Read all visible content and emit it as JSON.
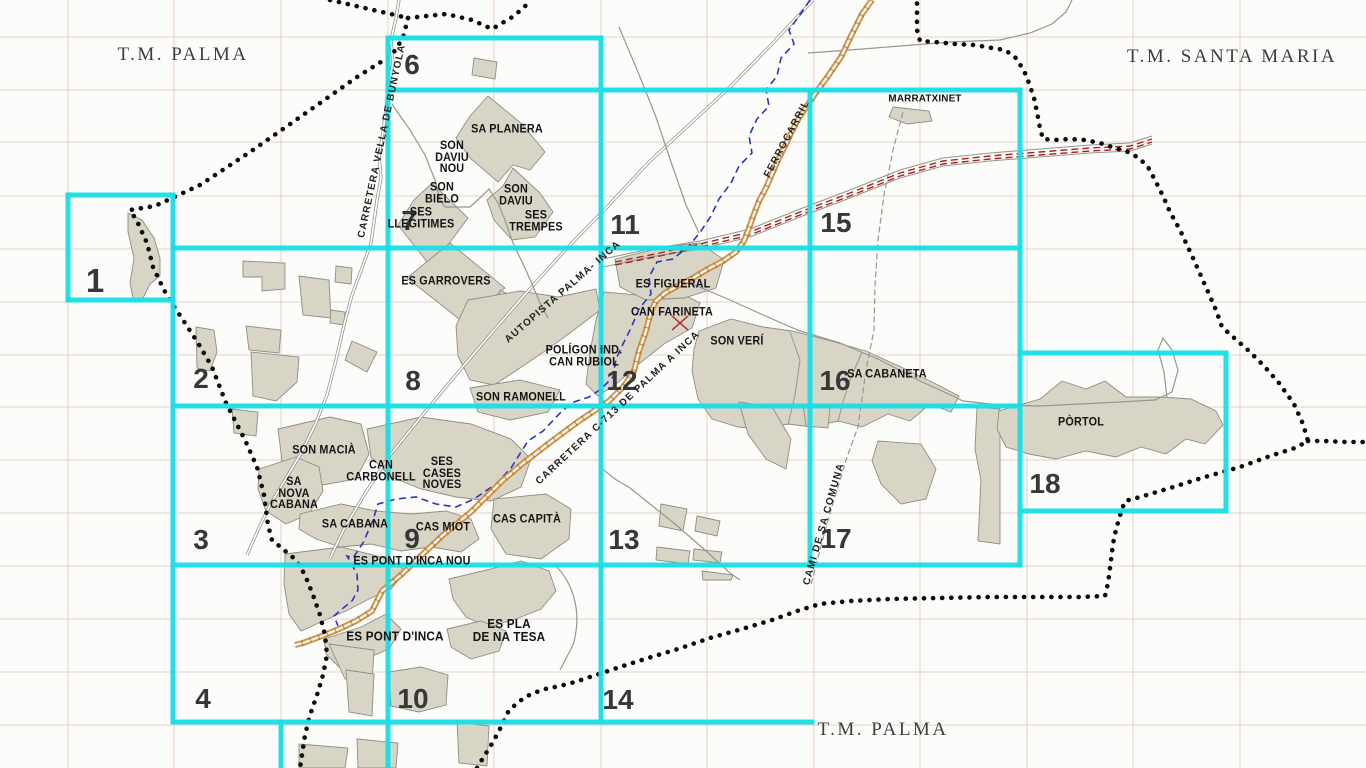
{
  "colors": {
    "background": "#fcfcfa",
    "sheet_grid": "#19dfe6",
    "boundary": "#0d0d0d",
    "railway": "#cd9043",
    "rail_core": "#f8f4ea",
    "rail_ties": "#9b6a28",
    "stream": "#2d35bd",
    "survey_grid": "#c98a80",
    "building_fill": "#d8d4c6",
    "building_outline": "#8f8e85",
    "road": "#979792",
    "red_line": "#a62421",
    "label": "#141414",
    "number": "#373737",
    "tm_label": "#3d3d3d"
  },
  "corner_labels": {
    "top_left": "T.M. PALMA",
    "top_right": "T.M. SANTA MARIA",
    "bottom": "T.M. PALMA"
  },
  "sheets": [
    {
      "number": "1"
    },
    {
      "number": "2"
    },
    {
      "number": "3"
    },
    {
      "number": "4"
    },
    {
      "number": "6"
    },
    {
      "number": "7"
    },
    {
      "number": "8"
    },
    {
      "number": "9"
    },
    {
      "number": "10"
    },
    {
      "number": "11"
    },
    {
      "number": "12"
    },
    {
      "number": "13"
    },
    {
      "number": "14"
    },
    {
      "number": "15"
    },
    {
      "number": "16"
    },
    {
      "number": "17"
    },
    {
      "number": "18"
    }
  ],
  "places": [
    {
      "text": "SA PLANERA"
    },
    {
      "text": "SON\nDAVIU\nNOU"
    },
    {
      "text": "SON\nDAVIU"
    },
    {
      "text": "SON\nBIELO"
    },
    {
      "text": "SES\nLLEGITIMES"
    },
    {
      "text": "SES\nTREMPES"
    },
    {
      "text": "ES GARROVERS"
    },
    {
      "text": "MARRATXINET"
    },
    {
      "text": "ES FIGUERAL"
    },
    {
      "text": "CAN FARINETA"
    },
    {
      "text": "SON VERÍ"
    },
    {
      "text": "POLÍGON IND.\nCAN RUBIOL"
    },
    {
      "text": "SON RAMONELL"
    },
    {
      "text": "SA CABANETA"
    },
    {
      "text": "PÒRTOL"
    },
    {
      "text": "SON MACIÀ"
    },
    {
      "text": "CAN\nCARBONELL"
    },
    {
      "text": "SES\nCASES\nNOVES"
    },
    {
      "text": "SA\nNOVA\nCABANA"
    },
    {
      "text": "SA CABANA"
    },
    {
      "text": "CAS MIOT"
    },
    {
      "text": "CAS CAPITÀ"
    },
    {
      "text": "ES PONT D'INCA NOU"
    },
    {
      "text": "ES PONT D'INCA"
    },
    {
      "text": "ES PLA\nDE NA TESA"
    }
  ],
  "roads": [
    {
      "text": "CARRETERA VELLA DE BUNYOLA"
    },
    {
      "text": "AUTOPISTA PALMA- INCA"
    },
    {
      "text": "FERROCARRIL"
    },
    {
      "text": "CARRETERA C-713 DE PALMA A INCA"
    },
    {
      "text": "CAMI DE SA COMUNA"
    }
  ]
}
